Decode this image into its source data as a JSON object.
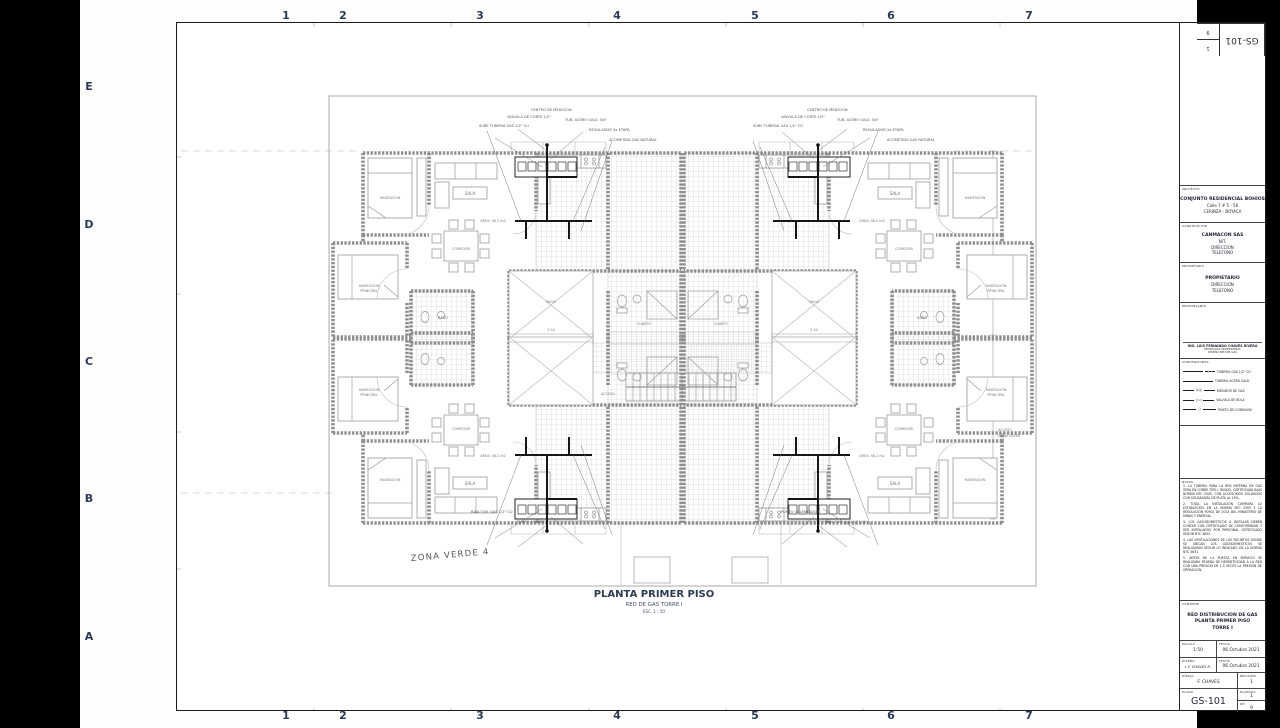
{
  "frame": {
    "grid_top": [
      "1",
      "2",
      "3",
      "4",
      "5",
      "6",
      "7"
    ],
    "grid_bottom": [
      "1",
      "2",
      "3",
      "4",
      "5",
      "6",
      "7"
    ],
    "grid_left": [
      "E",
      "D",
      "C",
      "B",
      "A"
    ]
  },
  "plan": {
    "title": "PLANTA PRIMER PISO",
    "subtitle": "RED DE GAS TORRE I",
    "scale_note": "ESC. 1 : 50",
    "zona_verde": "ZONA VERDE 4",
    "dimension": "2.54",
    "rooms": {
      "sala": "SALA",
      "comedor": "COMEDOR",
      "area": "AREA: 48.2 m2",
      "hab1": "HABITACION",
      "hab2": "PRINCIPAL",
      "habitacion": "HABITACION",
      "cuarto": "CUARTO",
      "bano": "BAÑO",
      "vacio": "VACIO",
      "acceso": "ACCESO",
      "acceso_zv1": "ACCESO",
      "acceso_zv2": "ZONA VERDE"
    },
    "annotations": [
      "SUBE TUBERIA GAS 1/2\" CU",
      "VALVULA DE CORTE 1/2\"",
      "CENTRO DE MEDICION",
      "TUB. ACERO GALV. 3/4\"",
      "REGULADOR 2a ETAPA",
      "ACOMETIDA GAS NATURAL",
      "BAJA TUB. GAS 1/2\" CU",
      "PUNTO ESTUFA",
      "PUNTO CALENTADOR"
    ]
  },
  "titleblock": {
    "rot": {
      "code": "GS-101",
      "sheet_no": "1",
      "sheet_total": "9",
      "mini_label": "PLANO"
    },
    "proyecto": {
      "label": "PROYECTO",
      "l1": "CONJUNTO RESIDENCIAL BOHIOS",
      "l2": "Calle 7 # 5 - 56",
      "l3": "CERINZA - BOYACA"
    },
    "constructora": {
      "label": "CONSTRUCTOR",
      "l1": "CANMACON SAS",
      "l2": "NIT.",
      "l3": "DIRECCION",
      "l4": "TELEFONO"
    },
    "propietario": {
      "label": "PROPIETARIO",
      "l1": "PROPIETARIO",
      "l2": "DIRECCION",
      "l3": "TELEFONO"
    },
    "responsable": {
      "label": "RESPONSABLE",
      "name": "ING. LUIS FERNANDO CHAVES RIVERA",
      "l1": "MATRICULA PROFESIONAL",
      "l2": "DISEÑO RED DE GAS"
    },
    "convenciones": {
      "label": "CONVENCIONES",
      "items": [
        "TUBERIA GAS 1/2\" CU",
        "TUBERIA ACERO GALV.",
        "MEDIDOR DE GAS",
        "VALVULA DE BOLA",
        "PUNTO DE CONEXION"
      ]
    },
    "notas": {
      "label": "NOTAS",
      "items": [
        "1. LA TUBERIA PARA LA RED INTERNA DE GAS SERA EN COBRE TIPO L RIGIDO, CERTIFICADA BAJO NORMA NTC 2505, CON ACCESORIOS SOLDADOS CON SOLDADURA DE PLATA AL 15%.",
        "2. TODA LA INSTALACION CUMPLIRA LO ESTABLECIDO EN LA NORMA NTC 2505 Y LA RESOLUCION 90902 DE 2013 DEL MINISTERIO DE MINAS Y ENERGIA.",
        "3. LOS GASODOMESTICOS A INSTALAR DEBEN CONTAR CON CERTIFICADO DE CONFORMIDAD Y SER INSTALADOS POR PERSONAL CERTIFICADO SEGUN NTC 3833.",
        "4. LAS VENTILACIONES DE LOS RECINTOS DONDE SE UBICAN LOS GASODOMESTICOS SE REALIZARAN SEGUN LO INDICADO EN LA NORMA NTC 3631.",
        "5. ANTES DE LA PUESTA EN SERVICIO SE REALIZARA PRUEBA DE HERMETICIDAD A LA RED CON UNA PRESION DE 1.5 VECES LA PRESION DE OPERACION."
      ]
    },
    "contiene": {
      "label": "CONTIENE",
      "l1": "RED DISTRIBUCION DE GAS",
      "l2": "PLANTA PRIMER PISO",
      "l3": "TORRE I"
    },
    "escala": {
      "label": "ESCALA",
      "value": "1:50"
    },
    "fecha_diseno": {
      "label": "FECHA",
      "value": "06 Octubre 2021"
    },
    "diseno": {
      "label": "DISEÑO",
      "value": "L.F. CHAVES R."
    },
    "fecha_dibujo": {
      "label": "FECHA",
      "value": "06 Octubre 2021"
    },
    "dibujo": {
      "label": "DIBUJO",
      "value": "F. CHAVES"
    },
    "revision": {
      "label": "REVISION",
      "value": "1"
    },
    "plano": {
      "label": "PLANO",
      "value": "GS-101"
    },
    "plancha": {
      "label": "PLANCHA",
      "value": "1"
    },
    "de": {
      "label": "DE",
      "value": "9"
    }
  }
}
